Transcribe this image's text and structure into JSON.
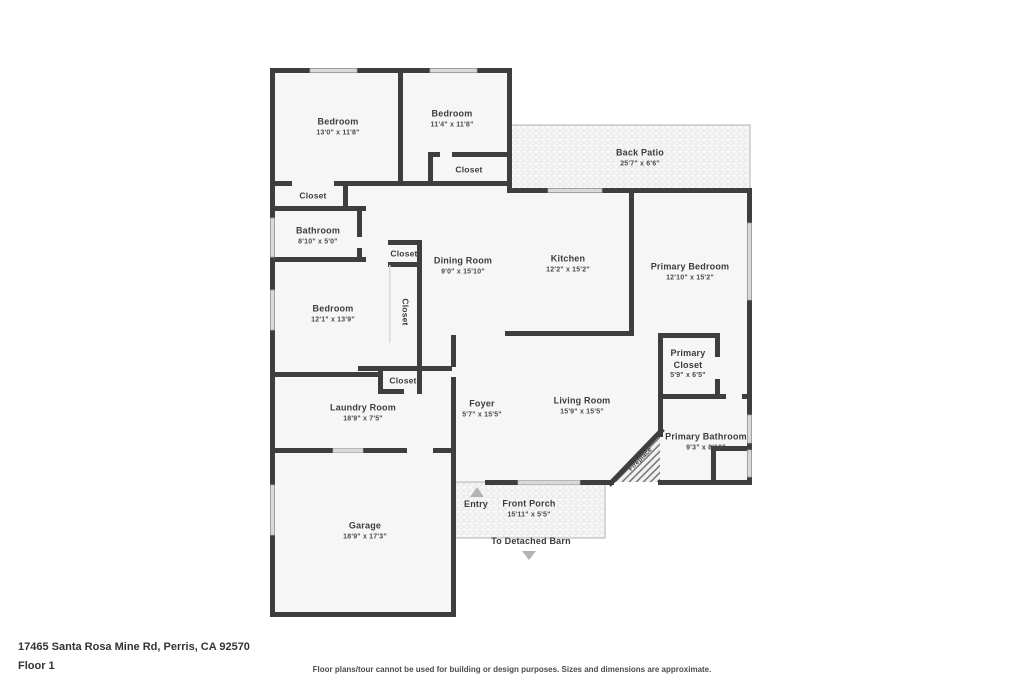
{
  "meta": {
    "address": "17465 Santa Rosa Mine Rd, Perris, CA 92570",
    "floor_label": "Floor 1",
    "disclaimer": "Floor plans/tour cannot be used for building or design purposes. Sizes and dimensions are approximate."
  },
  "colors": {
    "wall": "#3e3e3e",
    "room_fill": "#f6f6f6",
    "window_fill": "#d9d9d9",
    "label_text": "#3c3c3c",
    "arrow": "#b3b3b3"
  },
  "rooms": {
    "bedroom1": {
      "name": "Bedroom",
      "dims": "13'0\" x 11'8\""
    },
    "bedroom2": {
      "name": "Bedroom",
      "dims": "11'4\" x 11'8\""
    },
    "back_patio": {
      "name": "Back Patio",
      "dims": "25'7\" x 6'6\""
    },
    "closet_bedroom1": {
      "name": "Closet"
    },
    "closet_bedroom2": {
      "name": "Closet"
    },
    "bathroom": {
      "name": "Bathroom",
      "dims": "8'10\" x 5'0\""
    },
    "closet_hall_top": {
      "name": "Closet"
    },
    "closet_hall_tall": {
      "name": "Closet"
    },
    "closet_hall_bottom": {
      "name": "Closet"
    },
    "dining_room": {
      "name": "Dining Room",
      "dims": "9'0\" x 15'10\""
    },
    "kitchen": {
      "name": "Kitchen",
      "dims": "12'2\" x 15'2\""
    },
    "primary_bedroom": {
      "name": "Primary Bedroom",
      "dims": "12'10\" x 15'2\""
    },
    "bedroom3": {
      "name": "Bedroom",
      "dims": "12'1\" x 13'9\""
    },
    "primary_closet": {
      "name": "Primary Closet",
      "dims": "5'9\" x 6'5\""
    },
    "laundry_room": {
      "name": "Laundry Room",
      "dims": "18'9\" x 7'5\""
    },
    "foyer": {
      "name": "Foyer",
      "dims": "5'7\" x 15'5\""
    },
    "living_room": {
      "name": "Living Room",
      "dims": "15'9\" x 15'5\""
    },
    "primary_bathroom": {
      "name": "Primary Bathroom",
      "dims": "9'3\" x 8'10\""
    },
    "fireplace": {
      "name": "Fireplace"
    },
    "garage": {
      "name": "Garage",
      "dims": "18'9\" x 17'3\""
    },
    "entry": {
      "name": "Entry"
    },
    "front_porch": {
      "name": "Front Porch",
      "dims": "15'11\" x 5'5\""
    },
    "barn_note": {
      "name": "To Detached Barn"
    }
  }
}
